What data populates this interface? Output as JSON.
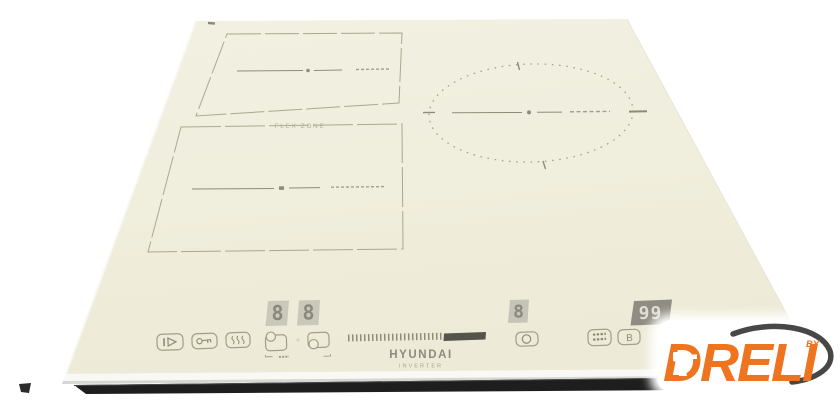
{
  "scene": {
    "description": "Beige flex-zone induction hob product photo on white background",
    "background_color": "#ffffff"
  },
  "cooktop": {
    "glass_color": "#f0eede",
    "marking_color": "#a7a48a",
    "front_trim_color": "#1e1e1e",
    "flex_zone_label": "FLEX ZONE",
    "displays": {
      "flex_back": "8",
      "flex_front": "8",
      "right_zone": "8",
      "timer": "99"
    },
    "controls": {
      "boost_label": "B",
      "icons": [
        {
          "name": "pause-icon"
        },
        {
          "name": "key-lock-icon"
        },
        {
          "name": "keep-warm-icon"
        },
        {
          "name": "flex-back-zone-icon"
        },
        {
          "name": "flex-front-zone-icon"
        },
        {
          "name": "power-slider-ticks"
        },
        {
          "name": "right-zone-select-icon"
        },
        {
          "name": "timer-function-icon"
        },
        {
          "name": "boost-button"
        }
      ]
    },
    "brand": {
      "name": "HYUNDAI",
      "tagline": "INVERTER"
    }
  },
  "watermark": {
    "name": "DRELI",
    "by_label": "BY",
    "text_color": "#ee7420",
    "swoosh_color": "#474747",
    "drill_icon": "drill-icon",
    "background": "#ffffff"
  }
}
